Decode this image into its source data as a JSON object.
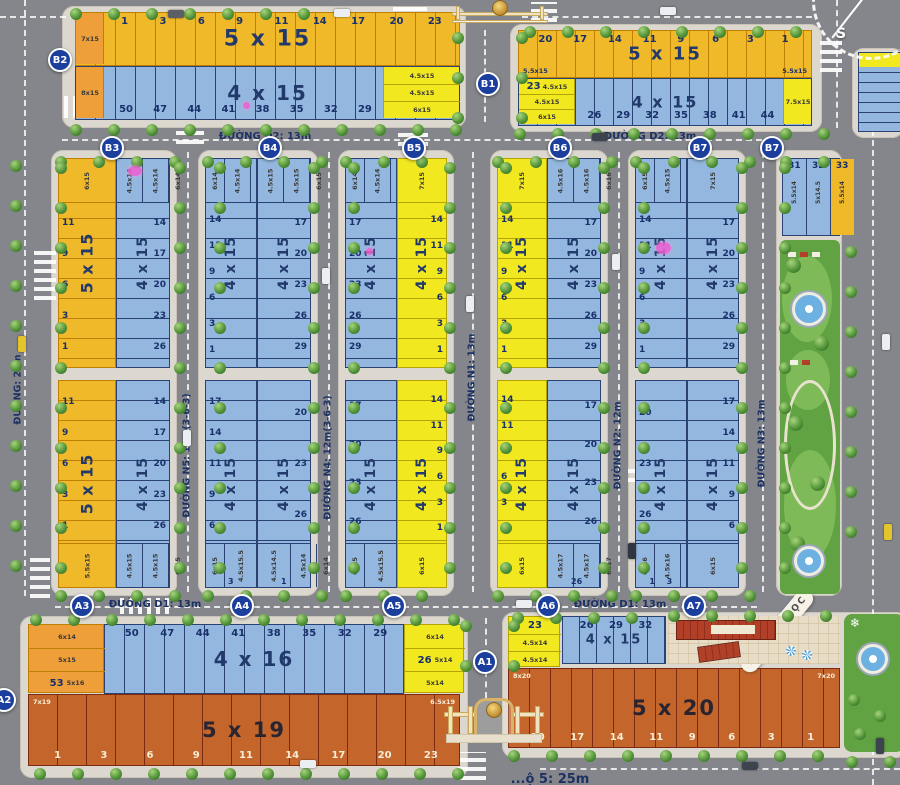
{
  "palette": {
    "gold": "#f0b929",
    "gold_line": "#bf7f00",
    "lemon": "#f2e81f",
    "lemon_line": "#b4a300",
    "blue": "#93b7de",
    "blue_line": "#2a4273",
    "orangeC": "#c4662c",
    "orangeC_line": "#7d2b10",
    "goldDark": "#ee9f3a",
    "goldDark_line": "#bf7f00",
    "num_navy": "#19306b",
    "num_cream": "#f8edd6",
    "circle_blue": "#1c3f9e",
    "pink": "#f05fd2",
    "park_green": "#61a243",
    "school_paving": "#e7dcc6",
    "roof_red": "#b23f28"
  },
  "street_labels": {
    "d2_left": "ĐƯỜNG D2: 13m",
    "d2_right": "ĐƯỜNG D2: 13m",
    "d1_left": "ĐƯỜNG D1: 13m",
    "d1_right": "ĐƯỜNG D1: 13m",
    "left_road": "ĐƯỜNG: 22m",
    "n5": "ĐƯỜNG N5: 12m(3-6-3)",
    "n4": "ĐƯỜNG N4: 12m(3-6-3)",
    "n1": "ĐƯỜNG N1: 13m",
    "n2": "ĐƯỜNG N2: 12m",
    "n3": "ĐƯỜNG N3: 13m",
    "bottom_partial": "...ộ 5: 25m"
  },
  "school": {
    "label": "TRƯỜNG HỌC"
  },
  "compass": {
    "s": "S"
  },
  "markers": [
    {
      "id": "B2",
      "x": 60,
      "y": 60
    },
    {
      "id": "B1",
      "x": 488,
      "y": 84
    },
    {
      "id": "B3",
      "x": 112,
      "y": 148
    },
    {
      "id": "B4",
      "x": 270,
      "y": 148
    },
    {
      "id": "B5",
      "x": 414,
      "y": 148
    },
    {
      "id": "B6",
      "x": 560,
      "y": 148
    },
    {
      "id": "B7",
      "x": 700,
      "y": 148
    },
    {
      "id": "B7",
      "x": 772,
      "y": 148
    },
    {
      "id": "A3",
      "x": 82,
      "y": 606
    },
    {
      "id": "A4",
      "x": 242,
      "y": 606
    },
    {
      "id": "A5",
      "x": 394,
      "y": 606
    },
    {
      "id": "A6",
      "x": 548,
      "y": 606
    },
    {
      "id": "A7",
      "x": 694,
      "y": 606
    },
    {
      "id": "A1",
      "x": 485,
      "y": 662
    },
    {
      "id": "A2",
      "x": 4,
      "y": 700
    }
  ],
  "top_rows": [
    {
      "id": "b2-yellow",
      "x": 75,
      "y": 12,
      "w": 385,
      "h": 54,
      "pitch": 20,
      "color": "gold",
      "size": "5 x 15",
      "labelSize": 22,
      "numSide": "top",
      "numColor": "navy",
      "nums": [
        "1",
        "3",
        "6",
        "9",
        "11",
        "14",
        "17",
        "20",
        "23"
      ],
      "endLeft": {
        "color": "goldDark",
        "w": 28,
        "cells": [
          {
            "dim": "7x15"
          }
        ]
      }
    },
    {
      "id": "b2-blue",
      "x": 75,
      "y": 66,
      "w": 385,
      "h": 54,
      "pitch": 20,
      "color": "blue",
      "size": "4 x 15",
      "labelSize": 20,
      "numSide": "bottom",
      "numColor": "navy",
      "nums": [
        "50",
        "47",
        "44",
        "41",
        "38",
        "35",
        "32",
        "29"
      ],
      "endLeft": {
        "color": "goldDark",
        "w": 28,
        "cells": [
          {
            "dim": "8x15"
          }
        ]
      },
      "endRight": {
        "color": "lemon",
        "w": 76,
        "cells": [
          {
            "dim": "4.5x15"
          },
          {
            "dim": "4.5x15"
          },
          {
            "dim": "6x15"
          }
        ]
      }
    },
    {
      "id": "b1-yellow",
      "x": 518,
      "y": 30,
      "w": 294,
      "h": 48,
      "pitch": 19,
      "color": "gold",
      "size": "5 x 15",
      "labelSize": 18,
      "numSide": "top",
      "numColor": "navy",
      "nums": [
        "20",
        "17",
        "14",
        "11",
        "9",
        "6",
        "3",
        "1"
      ],
      "noteLeft": "5.5x15",
      "noteRight": "5.5x15",
      "notePos": "bottom"
    },
    {
      "id": "b1-blue",
      "x": 518,
      "y": 78,
      "w": 294,
      "h": 48,
      "pitch": 19,
      "color": "blue",
      "size": "4 x 15",
      "labelSize": 16,
      "numSide": "bottom",
      "numColor": "navy",
      "nums": [
        "26",
        "29",
        "32",
        "35",
        "38",
        "41",
        "44"
      ],
      "endLeft": {
        "color": "lemon",
        "w": 56,
        "cells": [
          {
            "num": "23",
            "dim": "4.5x15"
          },
          {
            "dim": "4.5x15"
          },
          {
            "dim": "6x15"
          }
        ]
      },
      "endRight": {
        "color": "lemon",
        "w": 28,
        "cells": [
          {
            "dim": "7.5x15"
          }
        ]
      }
    },
    {
      "id": "a2-blue",
      "x": 104,
      "y": 624,
      "w": 300,
      "h": 70,
      "pitch": 20,
      "color": "blue",
      "size": "4 x 16",
      "labelSize": 20,
      "numSide": "top",
      "numColor": "navy",
      "nums": [
        "50",
        "47",
        "44",
        "41",
        "38",
        "35",
        "32",
        "29"
      ]
    },
    {
      "id": "a2-orange",
      "x": 28,
      "y": 694,
      "w": 432,
      "h": 72,
      "pitch": 29,
      "color": "orangeC",
      "size": "5 x 19",
      "labelSize": 21,
      "numSide": "bottom",
      "numColor": "cream",
      "nums": [
        "1",
        "3",
        "6",
        "9",
        "11",
        "14",
        "17",
        "20",
        "23"
      ],
      "noteLeft": "7x19",
      "noteRight": "6.5x19",
      "notePos": "top"
    },
    {
      "id": "a1-blue",
      "x": 562,
      "y": 616,
      "w": 104,
      "h": 48,
      "pitch": 17,
      "color": "blue",
      "size": "4 x 15",
      "labelSize": 13,
      "numSide": "top",
      "numColor": "navy",
      "nums": [
        "26",
        "29",
        "32"
      ]
    },
    {
      "id": "a1-orange",
      "x": 508,
      "y": 668,
      "w": 332,
      "h": 80,
      "pitch": 21,
      "color": "orangeC",
      "size": "5 x 20",
      "labelSize": 21,
      "numSide": "bottom",
      "numColor": "cream",
      "nums": [
        "20",
        "17",
        "14",
        "11",
        "9",
        "6",
        "3",
        "1"
      ],
      "noteLeft": "8x20",
      "noteRight": "7x20",
      "notePos": "top"
    }
  ],
  "mid": {
    "upper_y": 158,
    "upper_h": 210,
    "lower_y": 380,
    "lower_h": 208,
    "columns_upper": [
      {
        "x": 58,
        "w": 58,
        "color": "gold",
        "size": "5 x 15",
        "side": "left",
        "nums": [
          "11",
          "9",
          "6",
          "3",
          "1"
        ],
        "subsTop": [
          "6x15"
        ]
      },
      {
        "x": 116,
        "w": 54,
        "color": "blue",
        "size": "4 x 15",
        "side": "right",
        "nums": [
          "14",
          "17",
          "20",
          "23",
          "26"
        ],
        "subsTop": [
          "4.5x14",
          "4.5x14",
          "6x14"
        ]
      },
      {
        "x": 205,
        "w": 52,
        "color": "blue",
        "size": "4 x 15",
        "side": "left",
        "nums": [
          "14",
          "11",
          "9",
          "6",
          "3",
          "1"
        ],
        "subsTop": [
          "6x14",
          "4.5x14",
          "4.5x14"
        ]
      },
      {
        "x": 257,
        "w": 54,
        "color": "blue",
        "size": "4 x 15",
        "side": "right",
        "nums": [
          "17",
          "20",
          "23",
          "26",
          "29"
        ],
        "subsTop": [
          "4.5x15",
          "4.5x15",
          "6x15"
        ]
      },
      {
        "x": 345,
        "w": 52,
        "color": "blue",
        "size": "4 x 15",
        "side": "left",
        "nums": [
          "17",
          "20",
          "23",
          "26",
          "29"
        ],
        "subsTop": [
          "6x14",
          "4.5x14",
          "4.5x14"
        ]
      },
      {
        "x": 397,
        "w": 50,
        "color": "lemon",
        "size": "4 x 15",
        "side": "right",
        "nums": [
          "14",
          "11",
          "9",
          "6",
          "3",
          "1"
        ],
        "subsTop": [
          "7x15"
        ]
      },
      {
        "x": 497,
        "w": 50,
        "color": "lemon",
        "size": "4 x 15",
        "side": "left",
        "nums": [
          "14",
          "11",
          "9",
          "6",
          "3",
          "1"
        ],
        "subsTop": [
          "7x15"
        ]
      },
      {
        "x": 547,
        "w": 54,
        "color": "blue",
        "size": "4 x 15",
        "side": "right",
        "nums": [
          "17",
          "20",
          "23",
          "26",
          "29"
        ],
        "subsTop": [
          "4.5x16",
          "4.5x16",
          "6x16"
        ]
      },
      {
        "x": 635,
        "w": 52,
        "color": "blue",
        "size": "4 x 15",
        "side": "left",
        "nums": [
          "14",
          "11",
          "9",
          "6",
          "3",
          "1"
        ],
        "subsTop": [
          "6x15",
          "4.5x15",
          "4.5x15"
        ]
      },
      {
        "x": 687,
        "w": 52,
        "color": "blue",
        "size": "4 x 15",
        "side": "right",
        "nums": [
          "17",
          "20",
          "23",
          "26",
          "29"
        ],
        "subsTop": [
          "7x15"
        ]
      }
    ],
    "columns_lower": [
      {
        "x": 58,
        "w": 58,
        "color": "gold",
        "size": "5 x 15",
        "side": "left",
        "nums": [
          "11",
          "9",
          "6",
          "3",
          "1"
        ],
        "subsBottom": [
          "5.5x15"
        ]
      },
      {
        "x": 116,
        "w": 54,
        "color": "blue",
        "size": "4 x 15",
        "side": "right",
        "nums": [
          "14",
          "17",
          "20",
          "23",
          "26"
        ],
        "subsBottom": [
          "4.5x15",
          "4.5x15",
          "6x15"
        ]
      },
      {
        "x": 205,
        "w": 52,
        "color": "blue",
        "size": "4 x 15",
        "side": "left",
        "nums": [
          "17",
          "14",
          "11",
          "9",
          "6"
        ],
        "subsBottom": [
          "6x15",
          "4.5x15.5",
          "4.5x15"
        ],
        "bottomNums": [
          "3"
        ]
      },
      {
        "x": 257,
        "w": 54,
        "color": "blue",
        "size": "4 x 15",
        "side": "right",
        "nums": [
          "20",
          "23",
          "26"
        ],
        "subsBottom": [
          "4.5x14.5",
          "4.5x14",
          "6x14"
        ],
        "bottomNums": [
          "1"
        ]
      },
      {
        "x": 345,
        "w": 52,
        "color": "blue",
        "size": "4 x 15",
        "side": "left",
        "nums": [
          "17",
          "20",
          "23",
          "26"
        ],
        "subsBottom": [
          "6x15",
          "4.5x15.5",
          "4.5x15"
        ]
      },
      {
        "x": 397,
        "w": 50,
        "color": "lemon",
        "size": "4 x 15",
        "side": "right",
        "nums": [
          "14",
          "11",
          "9",
          "6",
          "3",
          "1"
        ],
        "subsBottom": [
          "6x15"
        ]
      },
      {
        "x": 497,
        "w": 50,
        "color": "lemon",
        "size": "4 x 15",
        "side": "left",
        "nums": [
          "14",
          "11",
          "9",
          "6",
          "3",
          "1"
        ],
        "subsBottom": [
          "6x15"
        ]
      },
      {
        "x": 547,
        "w": 54,
        "color": "blue",
        "size": "4 x 15",
        "side": "right",
        "nums": [
          "17",
          "20",
          "23",
          "26"
        ],
        "subsBottom": [
          "4.5x17",
          "4.5x17",
          "6x17"
        ],
        "bottomNums": [
          "26"
        ]
      },
      {
        "x": 635,
        "w": 52,
        "color": "blue",
        "size": "4 x 15",
        "side": "left",
        "nums": [
          "20",
          "23",
          "26"
        ],
        "subsBottom": [
          "6x16",
          "4.5x16",
          "4.5x15.5"
        ],
        "bottomNums": [
          "1",
          "3"
        ]
      },
      {
        "x": 687,
        "w": 52,
        "color": "blue",
        "size": "4 x 15",
        "side": "right",
        "nums": [
          "17",
          "14",
          "11",
          "9",
          "6"
        ],
        "subsBottom": [
          "6x15"
        ]
      }
    ]
  },
  "corner_block": {
    "x": 782,
    "y": 158,
    "w": 58,
    "h": 78,
    "cells": [
      {
        "num": "31",
        "dim": "5.5x14",
        "color": "blue"
      },
      {
        "num": "32",
        "dim": "5x14.5",
        "color": "blue"
      },
      {
        "num": "33",
        "dim": "5.5x14",
        "color": "gold"
      }
    ]
  },
  "stacks": [
    {
      "id": "a2-corner",
      "x": 28,
      "y": 624,
      "w": 76,
      "rowH": 23,
      "color": "goldDark",
      "rows": [
        {
          "dim": "6x14"
        },
        {
          "dim": "5x15"
        },
        {
          "num": "53",
          "dim": "5x16"
        }
      ]
    },
    {
      "id": "a2-end",
      "x": 404,
      "y": 624,
      "w": 60,
      "rowH": 23,
      "color": "lemon",
      "rows": [
        {
          "dim": "6x14"
        },
        {
          "num": "26",
          "dim": "5x14"
        },
        {
          "dim": "5x14"
        }
      ]
    },
    {
      "id": "a1-yellow",
      "x": 508,
      "y": 616,
      "w": 52,
      "rowH": 17,
      "color": "lemon",
      "rows": [
        {
          "num": "23"
        },
        {
          "dim": "4.5x14"
        },
        {
          "dim": "4.5x14"
        }
      ]
    }
  ],
  "highlights": [
    {
      "x": 128,
      "y": 166,
      "w": 14,
      "h": 10
    },
    {
      "x": 243,
      "y": 102,
      "w": 7,
      "h": 7
    },
    {
      "x": 366,
      "y": 248,
      "w": 7,
      "h": 7
    },
    {
      "x": 656,
      "y": 242,
      "w": 15,
      "h": 12
    }
  ]
}
